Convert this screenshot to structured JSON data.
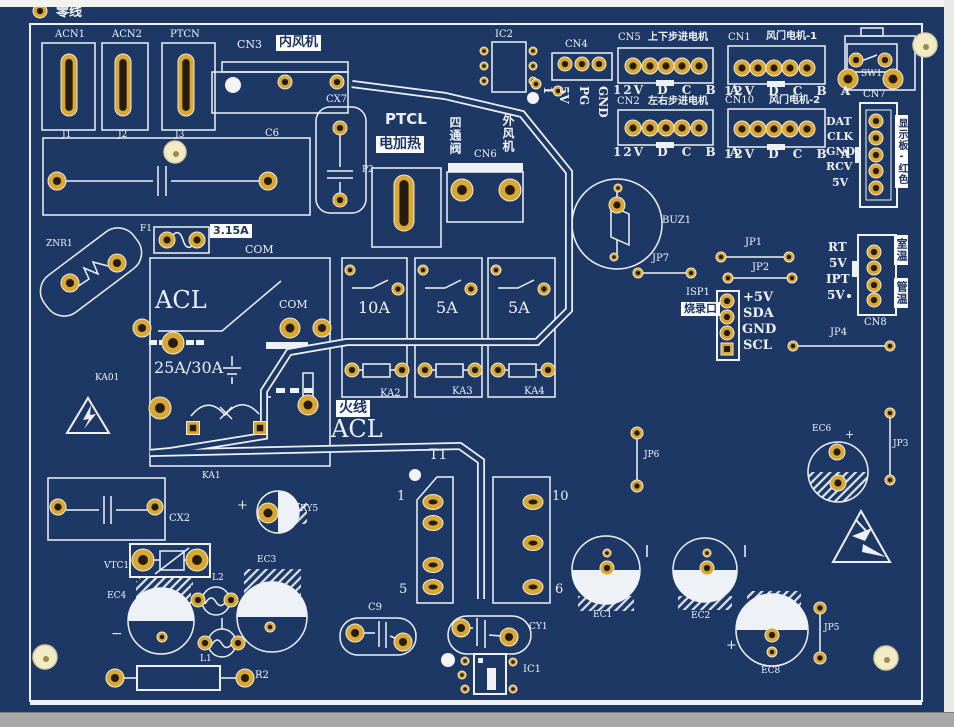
{
  "colors": {
    "board": "#1e3866",
    "silk": "#eef2f7",
    "pad_gold": "#d9a733",
    "pad_center": "#241c0e",
    "hole": "#f1ebc6",
    "tag_bg": "#fdfdfd",
    "tag_fg": "#1c3462",
    "chrome_top": "#f2f2ee",
    "chrome_side": "#e9e9e6",
    "chrome_bottom": "#a8a8a8"
  },
  "tl": {
    "neutral": "零线",
    "terminals": [
      {
        "ref": "ACN1",
        "pin": "J1"
      },
      {
        "ref": "ACN2",
        "pin": "J2"
      },
      {
        "ref": "PTCN",
        "pin": "J3"
      }
    ],
    "cn3": {
      "ref": "CN3",
      "tag": "内风机"
    },
    "c6": "C6",
    "cx7": "CX7",
    "p2": "P2"
  },
  "heater": {
    "ref": "PTCL",
    "tag": "电加热"
  },
  "cn6": {
    "ref": "CN6",
    "valve_tag": "四通阀",
    "fan_tag": "外风机"
  },
  "ic2": {
    "ref": "IC2"
  },
  "cn4": {
    "ref": "CN4",
    "pins": [
      "1",
      "5V",
      "PG",
      "GND"
    ]
  },
  "motors": [
    {
      "ref": "CN5",
      "tag": "上下步进电机",
      "pins": "12V D C B A"
    },
    {
      "ref": "CN2",
      "tag": "左右步进电机",
      "pins": "12V D C B A"
    },
    {
      "ref": "CN1",
      "tag": "风门电机-1",
      "pins": "12V D C B A"
    },
    {
      "ref": "CN10",
      "tag": "风门电机-2",
      "pins": "12V D C B A"
    }
  ],
  "sw1": {
    "ref": "SW1"
  },
  "cn7": {
    "ref": "CN7",
    "tag": "显示板-红色",
    "pins": [
      "DAT",
      "CLK",
      "GND",
      "RCV",
      "5V"
    ]
  },
  "buzzer": {
    "ref": "BUZ1"
  },
  "sensor": {
    "ref": "CN8",
    "tag_room": "室温",
    "tag_pipe": "管温",
    "pins": [
      "RT",
      "5V",
      "IPT",
      "5V"
    ]
  },
  "isp": {
    "ref": "ISP1",
    "tag": "烧录口",
    "pins": [
      "+5V",
      "SDA",
      "GND",
      "SCL"
    ]
  },
  "jumpers": {
    "jp1": "JP1",
    "jp2": "JP2",
    "jp3": "JP3",
    "jp4": "JP4",
    "jp5": "JP5",
    "jp6": "JP6",
    "jp7": "JP7"
  },
  "power": {
    "znr": "ZNR1",
    "fuse_ref": "F1",
    "fuse_rating": "3.15A",
    "com_top": "COM",
    "com_mid": "COM",
    "acl": "ACL",
    "rating": "25A/30A",
    "ka01": "KA01",
    "ka1": "KA1",
    "live_tag": "火线",
    "live_acl": "ACL"
  },
  "relays": [
    {
      "amp": "10A",
      "ref": "KA2"
    },
    {
      "amp": "5A",
      "ref": "KA3"
    },
    {
      "amp": "5A",
      "ref": "KA4"
    }
  ],
  "transformer": {
    "ref": "T1",
    "p1": "1",
    "p5": "5",
    "p10": "10",
    "p6": "6"
  },
  "passives": {
    "cx2": "CX2",
    "ry5": "RY5",
    "vtc1": "VTC1",
    "ec4": "EC4",
    "ec3": "EC3",
    "l2": "L2",
    "l1": "L1",
    "r2": "R2",
    "c9": "C9",
    "cy1": "CY1",
    "ic1": "IC1",
    "ec1": "EC1",
    "ec2": "EC2",
    "ec8": "EC8",
    "ec6": "EC6"
  },
  "marks": {
    "plus": "+",
    "minus": "−"
  }
}
